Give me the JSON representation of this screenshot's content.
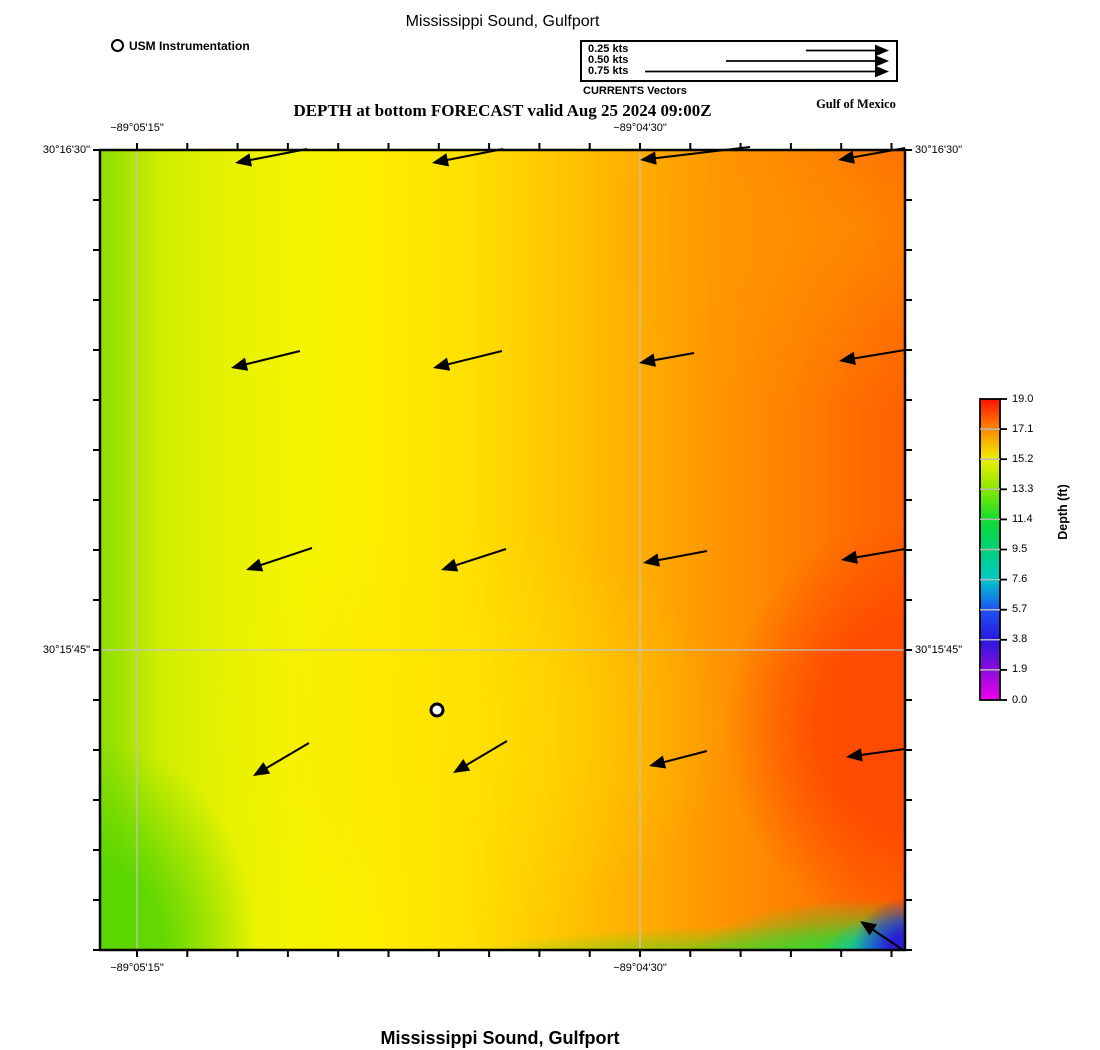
{
  "titles": {
    "top": "Mississippi Sound, Gulfport",
    "forecast": "DEPTH at bottom FORECAST valid Aug 25 2024 09:00Z",
    "gulf": "Gulf of Mexico",
    "bottom": "Mississippi Sound, Gulfport"
  },
  "legend": {
    "usm_label": "USM Instrumentation",
    "currents_caption": "CURRENTS Vectors",
    "speeds": [
      "0.25 kts",
      "0.50 kts",
      "0.75 kts"
    ],
    "arrows_px": [
      [
        806,
        50.5,
        889
      ],
      [
        726,
        61,
        889
      ],
      [
        645,
        71.5,
        889
      ]
    ]
  },
  "axes": {
    "lon_ticks": [
      {
        "label": "−89°05'15\"",
        "x_px": 137
      },
      {
        "label": "−89°04'30\"",
        "x_px": 640
      }
    ],
    "lat_ticks": [
      {
        "label": "30°16'30\"",
        "y_px": 150
      },
      {
        "label": "30°15'45\"",
        "y_px": 650
      }
    ]
  },
  "colorbar": {
    "label": "Depth (ft)",
    "ticks": [
      "19.0",
      "17.1",
      "15.2",
      "13.3",
      "11.4",
      "9.5",
      "7.6",
      "5.7",
      "3.8",
      "1.9",
      "0.0"
    ],
    "colors_top_to_bottom": [
      "#ff0f00",
      "#ff8800",
      "#eef000",
      "#8ae600",
      "#12dd2e",
      "#00cf7a",
      "#00c9c9",
      "#1d53f2",
      "#2b17e0",
      "#8c0cdd",
      "#ee00ee"
    ]
  },
  "chart_data": {
    "type": "heatmap",
    "title": "Mississippi Sound, Gulfport",
    "subtitle": "DEPTH at bottom FORECAST valid Aug 25 2024 09:00Z",
    "region": "Mississippi Sound, Gulfport",
    "forecast_valid": "Aug 25 2024 09:00Z",
    "variable": "Depth (ft)",
    "value_range": [
      0.0,
      19.0
    ],
    "colorbar_ticks": [
      19.0,
      17.1,
      15.2,
      13.3,
      11.4,
      9.5,
      7.6,
      5.7,
      3.8,
      1.9,
      0.0
    ],
    "x_axis": {
      "labels": [
        "−89°05'15\"",
        "−89°04'30\""
      ]
    },
    "y_axis": {
      "labels": [
        "30°16'30\"",
        "30°15'45\""
      ]
    },
    "annotations": [
      "Gulf of Mexico",
      "USM Instrumentation",
      "CURRENTS Vectors"
    ],
    "field_description": "Depth shading: ~13-14 ft (yellow-green) along the west edge, ~15 ft (yellow) through the center, 17-19 ft (orange-red) toward the east; a shallow 2-8 ft pocket (green-cyan-blue) in the extreme southeast corner",
    "station_marker_px": {
      "name": "USM Instrumentation",
      "x": 437,
      "y": 710
    },
    "current_vectors_note": "uniform westward / west-southwestward flow, roughly 0.25-0.5 kts; southeast corner vector points northwest",
    "vectors_px": [
      [
        235,
        163,
        307,
        149
      ],
      [
        432,
        163,
        503,
        149
      ],
      [
        640,
        160,
        750,
        147
      ],
      [
        838,
        160,
        905,
        148
      ],
      [
        231,
        368,
        300,
        351
      ],
      [
        433,
        368,
        502,
        351
      ],
      [
        639,
        363,
        694,
        353
      ],
      [
        839,
        361,
        905,
        350
      ],
      [
        246,
        570,
        312,
        548
      ],
      [
        441,
        570,
        506,
        549
      ],
      [
        643,
        563,
        707,
        551
      ],
      [
        841,
        560,
        905,
        549
      ],
      [
        253,
        776,
        309,
        743
      ],
      [
        453,
        773,
        507,
        741
      ],
      [
        649,
        766,
        707,
        751
      ],
      [
        846,
        757,
        905,
        749
      ],
      [
        860,
        921,
        903,
        950
      ]
    ]
  }
}
